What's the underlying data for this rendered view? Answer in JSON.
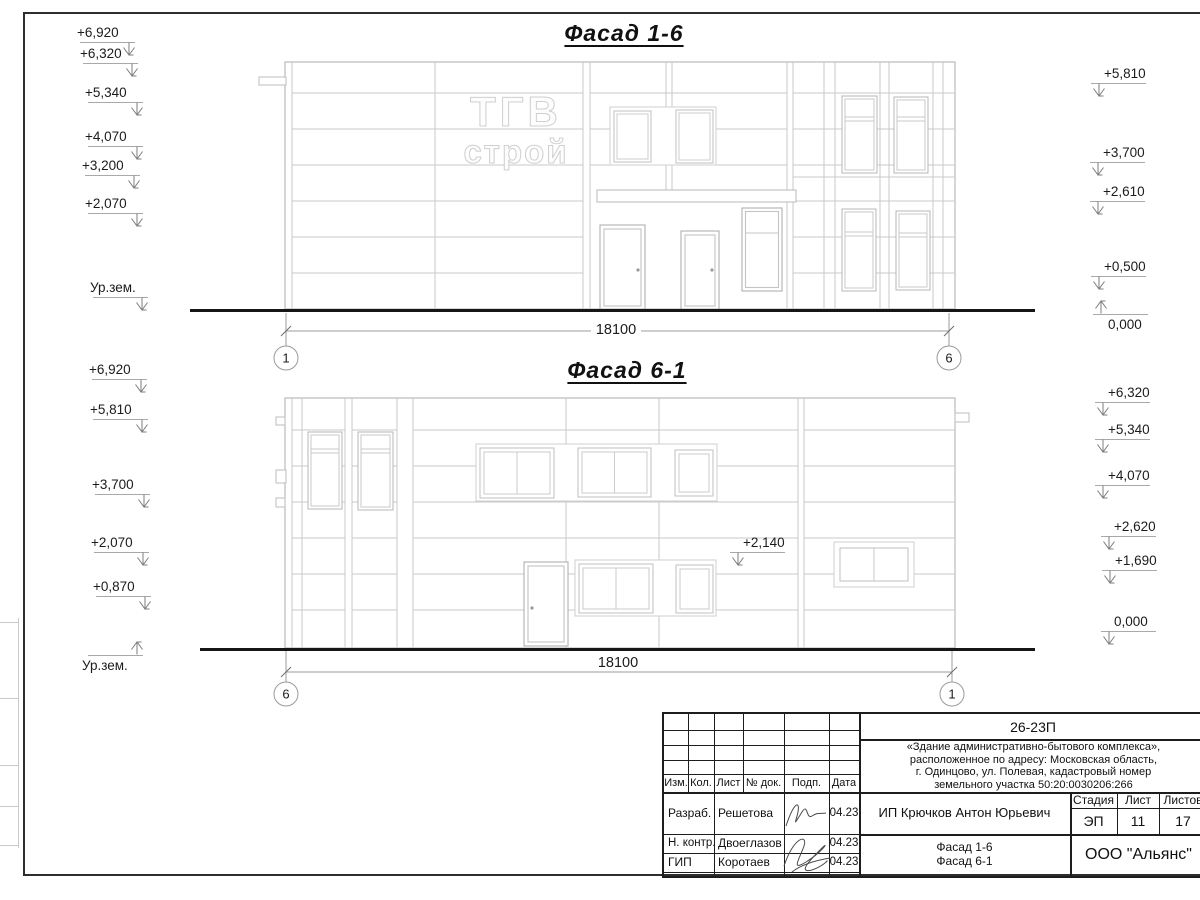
{
  "drawing": {
    "facade1": {
      "title": "Фасад 1-6",
      "sign_line1": "ТГВ",
      "sign_line2": "строй",
      "dimension": "18100",
      "axis_left": "1",
      "axis_right": "6",
      "left_marks": [
        {
          "label": "+6,920",
          "x": 80,
          "y": 42,
          "style": "L"
        },
        {
          "label": "+6,320",
          "x": 83,
          "y": 63,
          "style": "L"
        },
        {
          "label": "+5,340",
          "x": 88,
          "y": 102,
          "style": "L"
        },
        {
          "label": "+4,070",
          "x": 88,
          "y": 146,
          "style": "L"
        },
        {
          "label": "+3,200",
          "x": 85,
          "y": 175,
          "style": "L"
        },
        {
          "label": "+2,070",
          "x": 88,
          "y": 213,
          "style": "L"
        },
        {
          "label": "Ур.зем.",
          "x": 93,
          "y": 297,
          "style": "L"
        }
      ],
      "right_marks": [
        {
          "label": "+5,810",
          "x": 1091,
          "y": 83,
          "style": "R"
        },
        {
          "label": "+3,700",
          "x": 1090,
          "y": 162,
          "style": "R"
        },
        {
          "label": "+2,610",
          "x": 1090,
          "y": 201,
          "style": "R"
        },
        {
          "label": "+0,500",
          "x": 1091,
          "y": 276,
          "style": "R"
        },
        {
          "label": "0,000",
          "x": 1093,
          "y": 314,
          "style": "R-up"
        }
      ]
    },
    "facade2": {
      "title": "Фасад 6-1",
      "dimension": "18100",
      "axis_left": "6",
      "axis_right": "1",
      "left_marks": [
        {
          "label": "+6,920",
          "x": 92,
          "y": 379,
          "style": "L"
        },
        {
          "label": "+5,810",
          "x": 93,
          "y": 419,
          "style": "L"
        },
        {
          "label": "+3,700",
          "x": 95,
          "y": 494,
          "style": "L"
        },
        {
          "label": "+2,070",
          "x": 94,
          "y": 552,
          "style": "L"
        },
        {
          "label": "+0,870",
          "x": 96,
          "y": 596,
          "style": "L"
        },
        {
          "label": "Ур.зем.",
          "x": 88,
          "y": 655,
          "style": "L-up"
        }
      ],
      "right_marks": [
        {
          "label": "+6,320",
          "x": 1095,
          "y": 402,
          "style": "R"
        },
        {
          "label": "+5,340",
          "x": 1095,
          "y": 439,
          "style": "R"
        },
        {
          "label": "+4,070",
          "x": 1095,
          "y": 485,
          "style": "R"
        },
        {
          "label": "+2,620",
          "x": 1101,
          "y": 536,
          "style": "R"
        },
        {
          "label": "+1,690",
          "x": 1102,
          "y": 570,
          "style": "R"
        },
        {
          "label": "0,000",
          "x": 1101,
          "y": 631,
          "style": "R"
        }
      ],
      "mid_marks": [
        {
          "label": "+2,140",
          "x": 730,
          "y": 552,
          "style": "R"
        }
      ]
    }
  },
  "title_block": {
    "code": "26-23П",
    "desc_lines": [
      "«Здание административно-бытового комплекса»,",
      "расположенное по адресу: Московская область,",
      "г. Одинцово, ул. Полевая, кадастровый номер",
      "земельного участка 50:20:0030206:266"
    ],
    "header_cols": [
      "Изм.",
      "Кол.",
      "Лист",
      "№ док.",
      "Подп.",
      "Дата"
    ],
    "rows": [
      {
        "role": "Разраб.",
        "name": "Решетова",
        "date": "04.23"
      },
      {
        "role": "Н. контр.",
        "name": "Двоеглазов",
        "date": "04.23"
      },
      {
        "role": "ГИП",
        "name": "Коротаев",
        "date": "04.23"
      }
    ],
    "client": "ИП Крючков Антон Юрьевич",
    "stage_label": "Стадия",
    "sheet_label": "Лист",
    "sheets_label": "Листов",
    "stage": "ЭП",
    "sheet_no": "11",
    "sheets_total": "17",
    "content_line1": "Фасад 1-6",
    "content_line2": "Фасад 6-1",
    "company": "ООО \"Альянс\""
  }
}
